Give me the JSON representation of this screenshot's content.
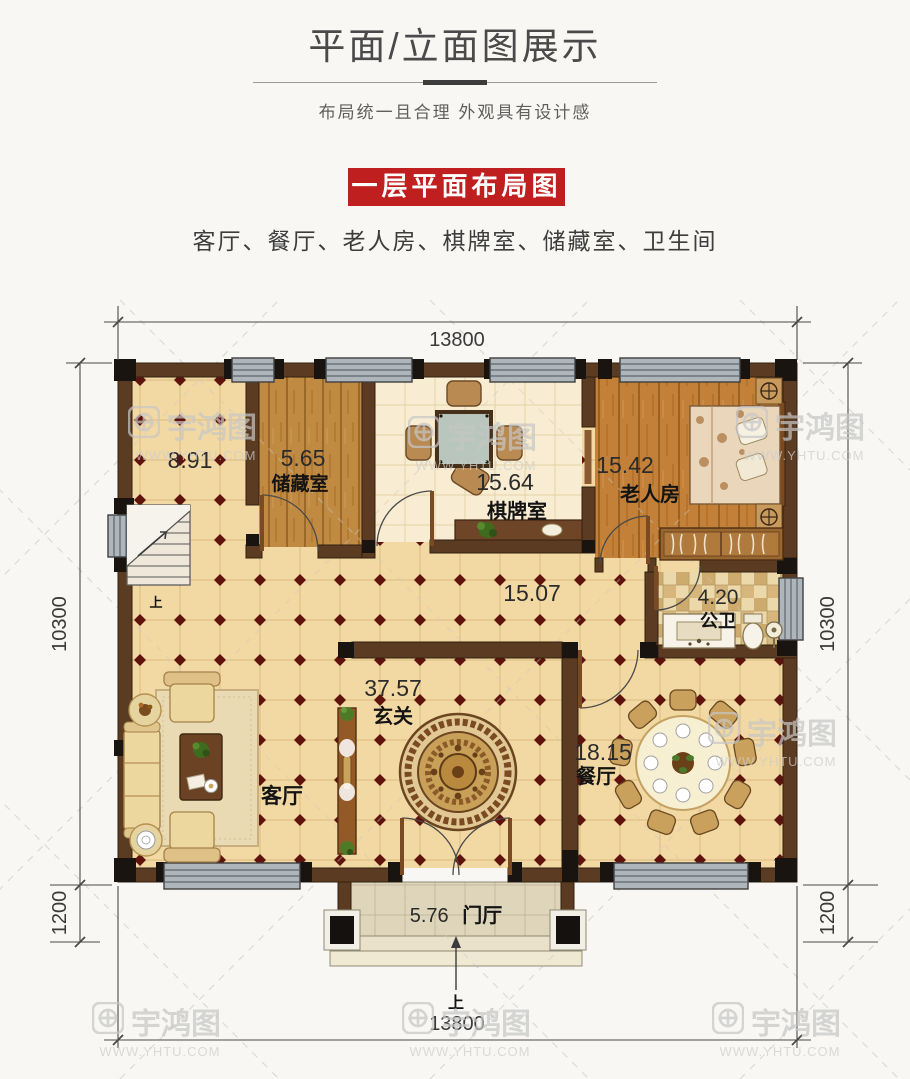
{
  "header": {
    "title": "平面/立面图展示",
    "subtitle": "布局统一且合理 外观具有设计感"
  },
  "banner": {
    "label": "一层平面布局图",
    "color": "#c01f1f"
  },
  "rooms_line": "客厅、餐厅、老人房、棋牌室、储藏室、卫生间",
  "watermark": {
    "brand": "宇鸿图",
    "url": "WWW.YHTU.COM"
  },
  "plan": {
    "dims": {
      "top": "13800",
      "bottom": "13800",
      "left_main": "10300",
      "left_porch": "1200",
      "right_main": "10300",
      "right_porch": "1200"
    },
    "up": "上",
    "rooms": {
      "stairwell": {
        "area": "8.91"
      },
      "storage": {
        "area": "5.65",
        "name": "储藏室"
      },
      "chess": {
        "area": "15.64",
        "name": "棋牌室"
      },
      "elder": {
        "area": "15.42",
        "name": "老人房"
      },
      "bath": {
        "area": "4.20",
        "name": "公卫"
      },
      "hall": {
        "area": "15.07"
      },
      "foyer": {
        "area": "37.57",
        "name": "玄关"
      },
      "living": {
        "name": "客厅"
      },
      "dining": {
        "area": "18.15",
        "name": "餐厅"
      },
      "porch": {
        "area": "5.76",
        "name": "门厅"
      }
    },
    "colors": {
      "wall": "#5b3b22",
      "floor": "#f2d8a2",
      "accent": "#c01f1f"
    }
  }
}
